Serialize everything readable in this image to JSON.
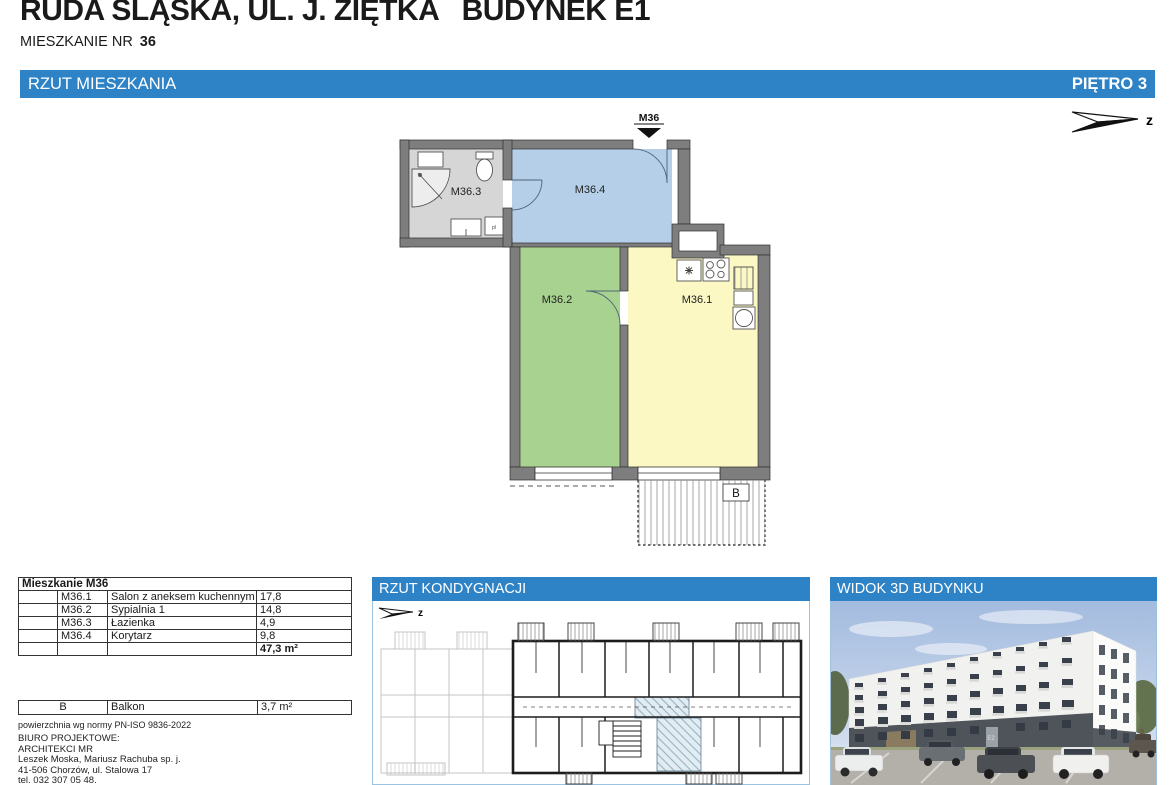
{
  "header": {
    "title": "RUDA ŚLĄSKA, UL. J. ZIĘTKA   BUDYNEK E1",
    "apartment_label": "MIESZKANIE NR",
    "apartment_number": "36"
  },
  "section_bar": {
    "title": "RZUT MIESZKANIA",
    "floor": "PIĘTRO 3"
  },
  "compass": {
    "direction": "z"
  },
  "floor_plan": {
    "entrance_label": "M36",
    "balcony_label": "B",
    "room_labels": {
      "living": "M36.1",
      "bedroom": "M36.2",
      "bathroom": "M36.3",
      "corridor": "M36.4"
    }
  },
  "area_table": {
    "title": "Mieszkanie M36",
    "rows": [
      {
        "code": "M36.1",
        "name": "Salon z aneksem kuchennym",
        "area": "17,8"
      },
      {
        "code": "M36.2",
        "name": "Sypialnia 1",
        "area": "14,8"
      },
      {
        "code": "M36.3",
        "name": "Łazienka",
        "area": "4,9"
      },
      {
        "code": "M36.4",
        "name": "Korytarz",
        "area": "9,8"
      }
    ],
    "total": "47,3 m²"
  },
  "balcony_table": {
    "code": "B",
    "name": "Balkon",
    "area": "3,7 m²"
  },
  "norm_note": "powierzchnia wg normy PN-ISO 9836-2022",
  "design_office": {
    "line1": "BIURO PROJEKTOWE:",
    "line2": "ARCHITEKCI MR",
    "line3": "Leszek Moska, Mariusz Rachuba sp. j.",
    "line4": "41-506 Chorzów, ul. Stalowa 17",
    "line5": "tel. 032 307 05 48."
  },
  "floor_layout_panel": {
    "title": "RZUT KONDYGNACJI",
    "compass": "z"
  },
  "view3d_panel": {
    "title": "WIDOK 3D BUDYNKU",
    "building_sign": "E2"
  },
  "colors": {
    "accent_blue": "#2e83c6",
    "room_living": "#fbf8c3",
    "room_bedroom": "#a8d28f",
    "room_bathroom": "#d6d6d6",
    "room_corridor": "#b5cfe9",
    "wall_gray": "#7e7e7e"
  }
}
